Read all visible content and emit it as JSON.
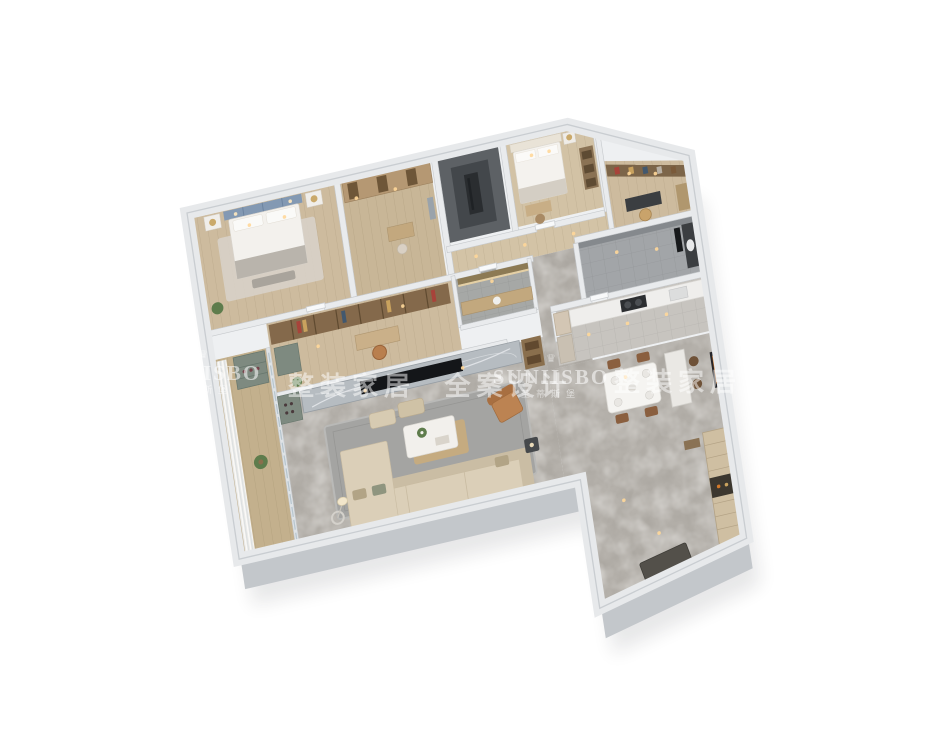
{
  "canvas": {
    "width": 950,
    "height": 733,
    "background_color": "#ffffff"
  },
  "render": {
    "type": "isometric-3d-floorplan",
    "subject": "apartment interior dollhouse cutaway render, viewed from above at an angle",
    "palette": {
      "background": "#ffffff",
      "outer_wall_top": "#e9ebed",
      "outer_wall_side": "#c3c7cb",
      "interior_wall": "#e9ebed",
      "wood_floor": "#cdbb9e",
      "balcony_wood": "#c3b08d",
      "marble_floor": "#b6b2ac",
      "dark_shaft": "#5d6165",
      "gray_tile": "#a2a5a8",
      "sofa_beige": "#dbcfb8",
      "armchair_tan": "#bc8352",
      "dining_chair_brown": "#8a5f3f",
      "cabinet_green_gray": "#7e8a80",
      "wardrobe_wood": "#b59873",
      "headboard_blue": "#8399b3",
      "tv_black": "#141619",
      "kitchen_counter": "#efeeec",
      "art_accent_orange": "#d2782a",
      "warm_light": "#ffd89a"
    },
    "rooms": [
      {
        "id": "master-bedroom",
        "floor": "wood"
      },
      {
        "id": "walk-in-closet",
        "floor": "wood"
      },
      {
        "id": "utility-shaft",
        "floor": "dark-tile"
      },
      {
        "id": "bedroom-2",
        "floor": "wood"
      },
      {
        "id": "study",
        "floor": "wood"
      },
      {
        "id": "bathroom-master",
        "floor": "gray-tile"
      },
      {
        "id": "kitchen",
        "floor": "tile"
      },
      {
        "id": "dining-area",
        "floor": "marble"
      },
      {
        "id": "hallway",
        "floor": "marble"
      },
      {
        "id": "bathroom-guest",
        "floor": "gray-tile"
      },
      {
        "id": "family-study-room",
        "floor": "wood"
      },
      {
        "id": "living-room",
        "floor": "marble"
      },
      {
        "id": "balcony",
        "floor": "wood"
      },
      {
        "id": "entry-foyer",
        "floor": "marble"
      }
    ]
  },
  "watermark": {
    "crown_icon": "♛",
    "brand_latin": "SUNIISBO",
    "brand_cn": "圣蒂斯堡",
    "slogan": "整装家居 全案设计",
    "text_color": "#ffffff"
  }
}
